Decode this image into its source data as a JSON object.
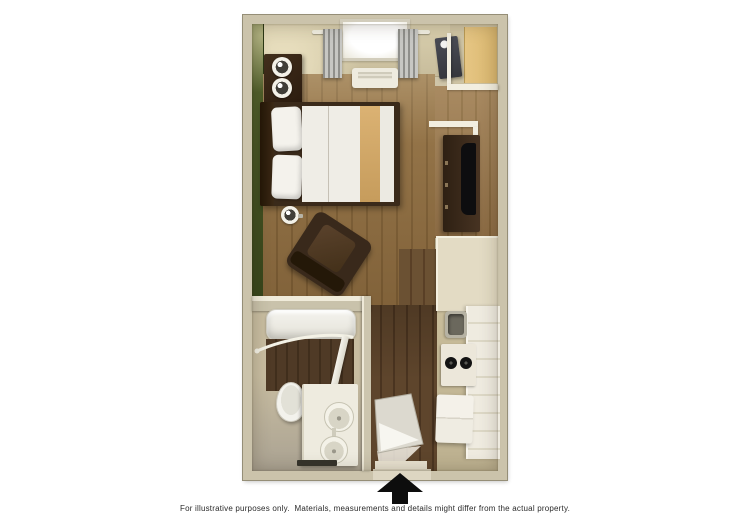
{
  "image": {
    "type": "3d-studio-floorplan",
    "caption": "For illustrative purposes only.  Materials, measurements and details might differ from the actual property.",
    "entrance_arrow_direction": "up"
  },
  "theme": {
    "background": "#ffffff",
    "wall": "#cbc3ab",
    "wall-line": "#958e77",
    "green-wall": "#46551f",
    "wood-light": "#8d6c40",
    "wood-dark": "#7c5d34",
    "hall-wood-light": "#5e452c",
    "hall-wood-dark": "#4a3420",
    "floor-beige": "#c9bd9e",
    "closet-tan": "#e6c684",
    "furniture-dark": "#36261a",
    "bed-runner-tan": "#c69c5c",
    "white-fixture": "#f0eee6",
    "curtain-gray": "#8f8f8b",
    "appliance-gray": "#6b685d",
    "arrow-black": "#0d0d0d",
    "caption-color": "#2a2a2a"
  }
}
